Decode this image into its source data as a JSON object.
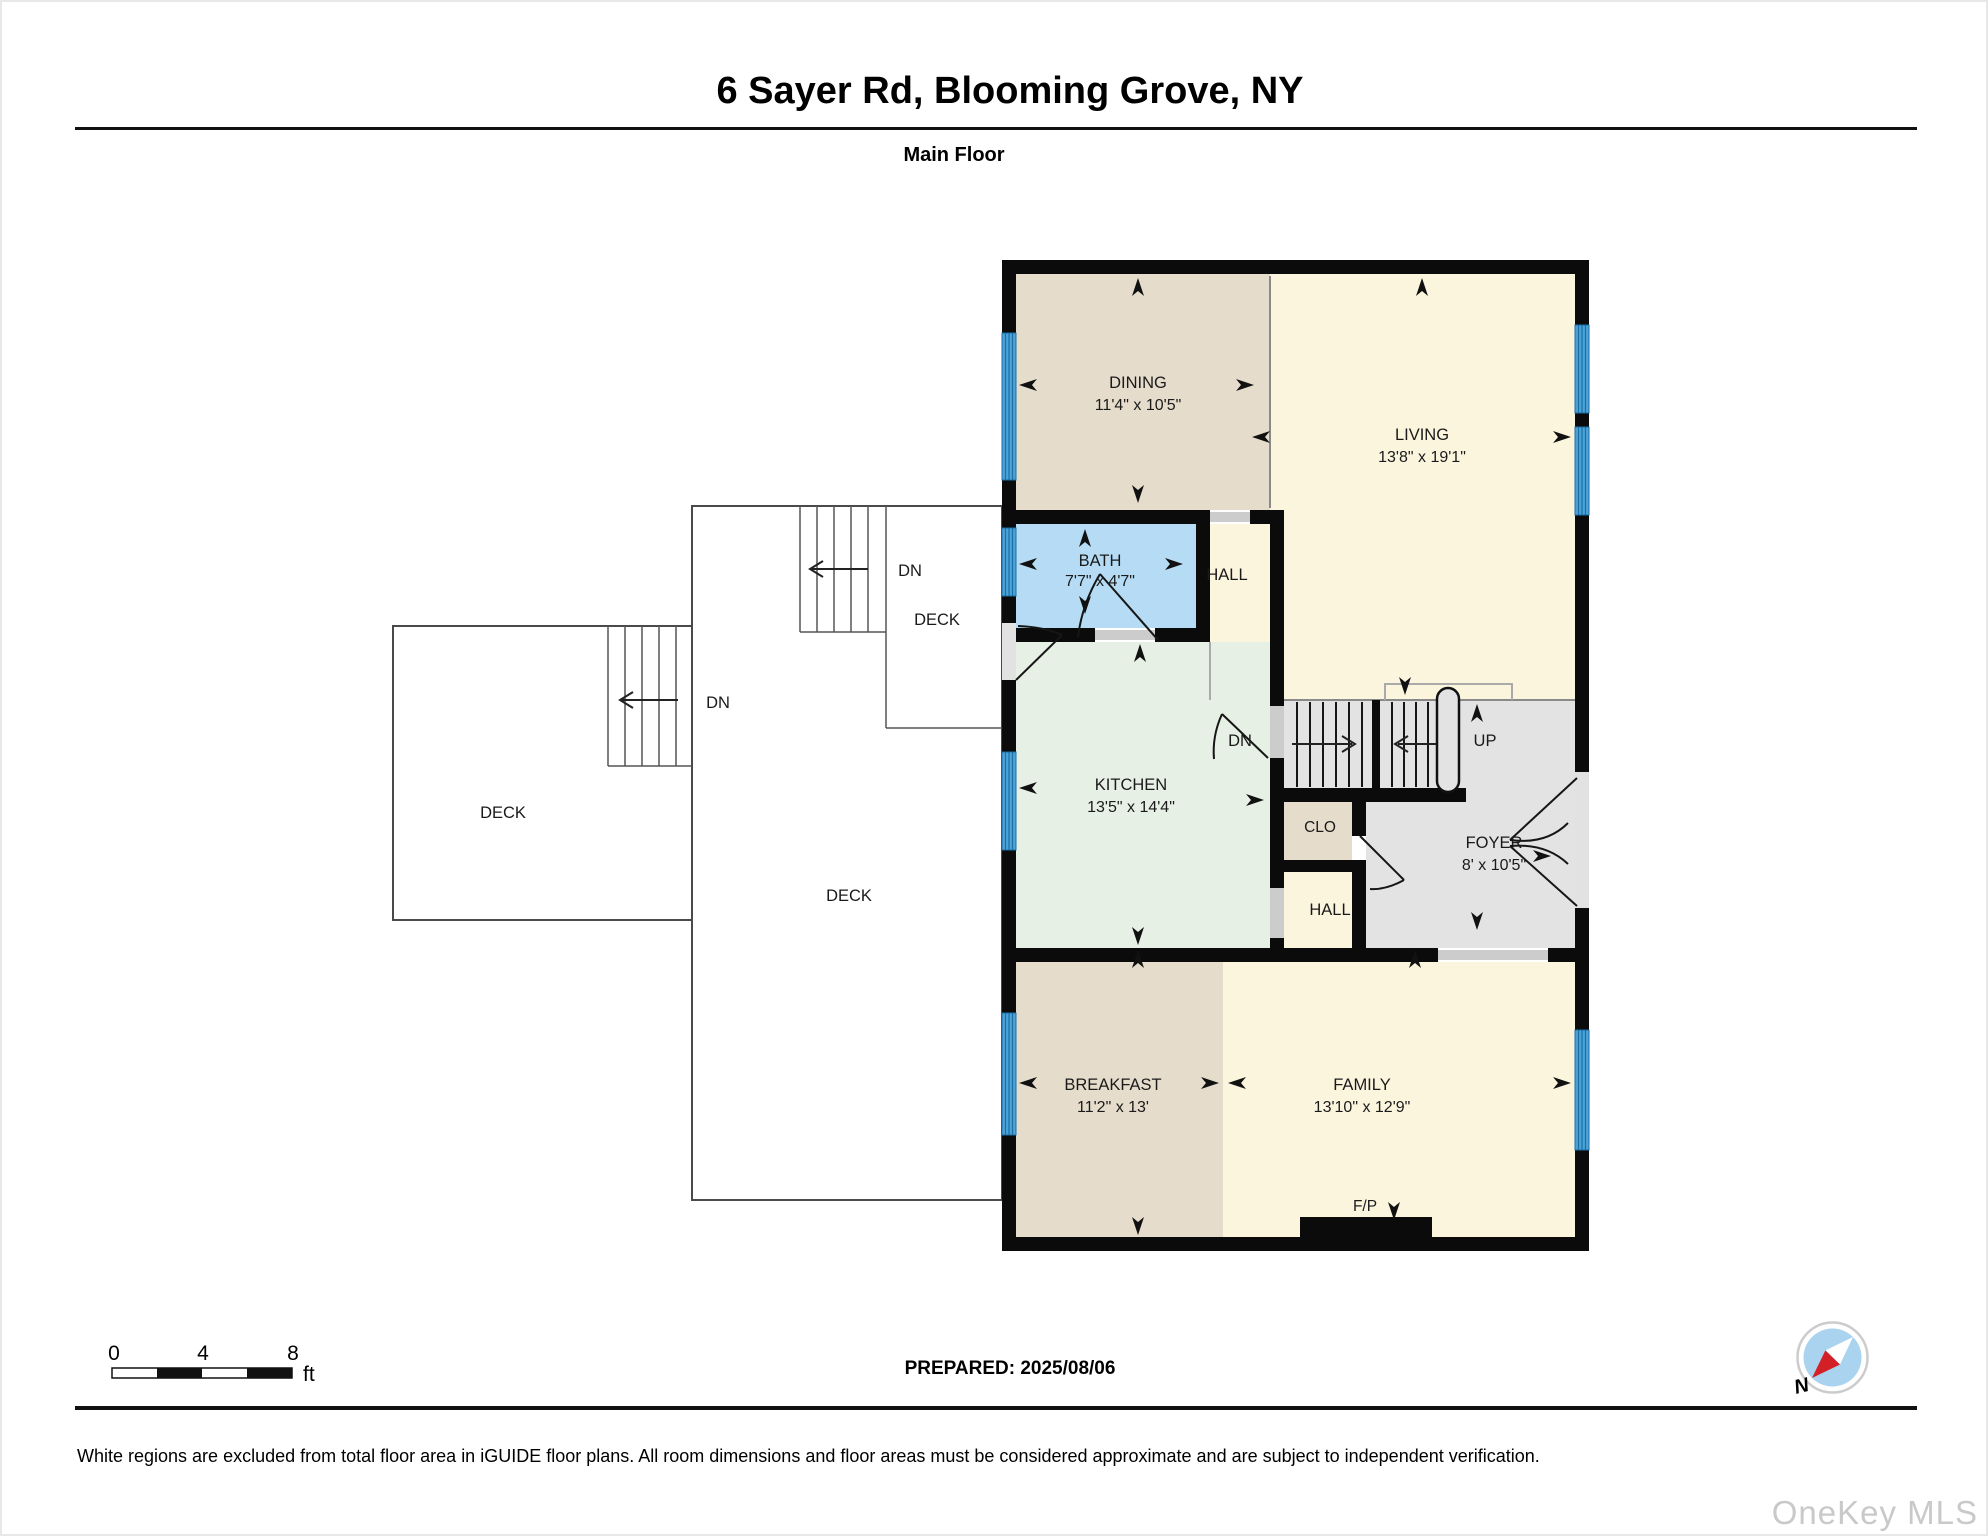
{
  "header": {
    "title": "6 Sayer Rd, Blooming Grove, NY",
    "subtitle": "Main Floor"
  },
  "rooms": {
    "dining": {
      "label": "DINING",
      "dims": "11'4\" x 10'5\""
    },
    "living": {
      "label": "LIVING",
      "dims": "13'8\" x 19'1\""
    },
    "bath": {
      "label": "BATH",
      "dims": "7'7\" x 4'7\""
    },
    "hall_upper": {
      "label": "HALL"
    },
    "kitchen": {
      "label": "KITCHEN",
      "dims": "13'5\" x 14'4\""
    },
    "clo": {
      "label": "CLO"
    },
    "foyer": {
      "label": "FOYER",
      "dims": "8' x 10'5\""
    },
    "hall_lower": {
      "label": "HALL"
    },
    "breakfast": {
      "label": "BREAKFAST",
      "dims": "11'2\" x 13'"
    },
    "family": {
      "label": "FAMILY",
      "dims": "13'10\" x 12'9\""
    },
    "fireplace_label": "F/P"
  },
  "decks": {
    "left": "DECK",
    "center": "DECK",
    "upper": "DECK"
  },
  "stairs": {
    "interior_down": "DN",
    "interior_up": "UP",
    "upper_deck_down": "DN",
    "left_deck_down": "DN"
  },
  "scale_bar": {
    "tick0": "0",
    "tick1": "4",
    "tick2": "8",
    "unit": "ft"
  },
  "compass": {
    "north_label": "N"
  },
  "footer": {
    "prepared": "PREPARED: 2025/08/06",
    "disclaimer": "White regions are excluded from total floor area in iGUIDE floor plans. All room dimensions and floor areas must be considered approximate and are subject to independent verification.",
    "watermark": "OneKey MLS"
  },
  "colors": {
    "room_tan": "#e6dccb",
    "room_cream": "#fbf5de",
    "room_blue": "#b5dcf4",
    "room_green": "#e7f0e5",
    "room_gray": "#e3e3e3",
    "wall": "#0b0b0b",
    "window_blue": "#4da3d8"
  }
}
